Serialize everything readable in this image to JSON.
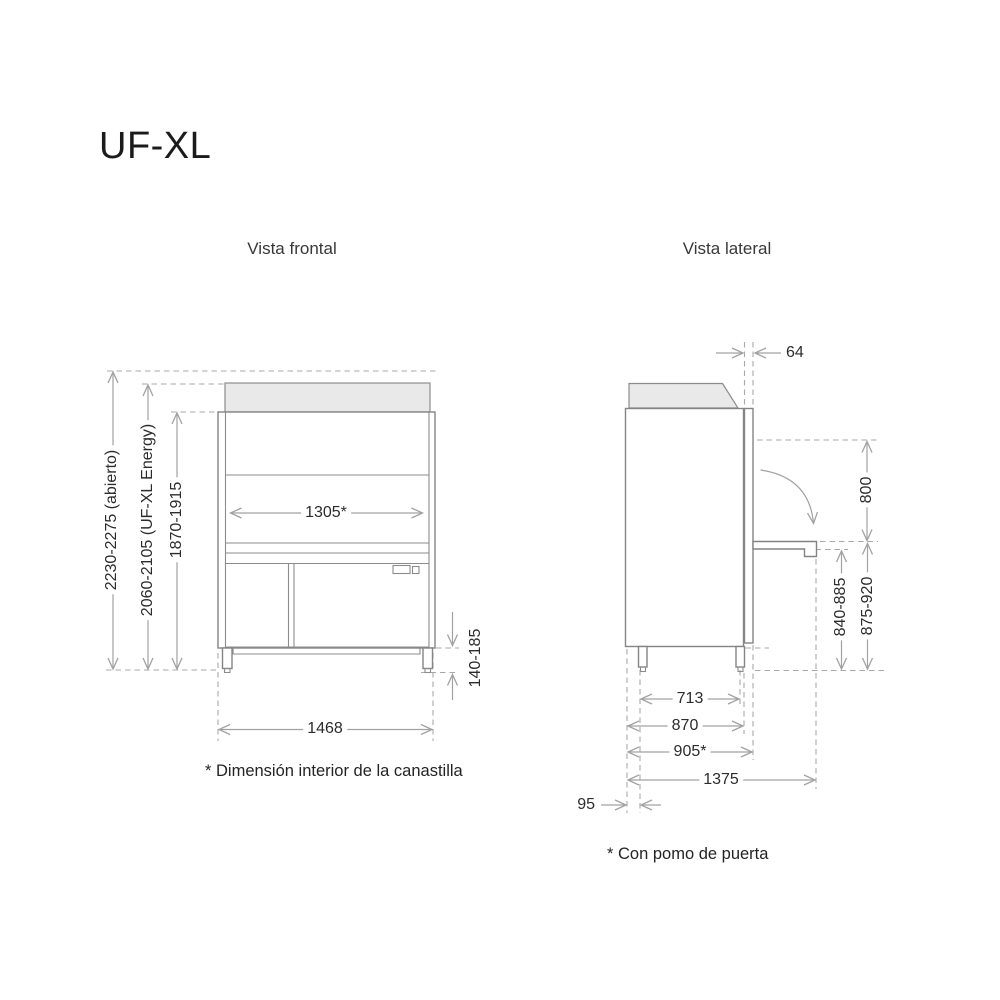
{
  "title": "UF-XL",
  "views": {
    "front": {
      "label": "Vista frontal",
      "note": "* Dimensión interior de la canastilla",
      "dimensions": {
        "overall_height_open": "2230-2275 (abierto)",
        "overall_height_energy": "2060-2105 (UF-XL Energy)",
        "overall_height": "1870-1915",
        "basket_interior_width": "1305*",
        "leg_height": "140-185",
        "overall_width": "1468"
      }
    },
    "side": {
      "label": "Vista lateral",
      "note": "* Con pomo de puerta",
      "dimensions": {
        "door_thickness": "64",
        "door_clearance_height": "800",
        "handle_height_low": "840-885",
        "handle_height_high": "875-920",
        "leg_spacing_depth": "713",
        "body_depth": "870",
        "depth_with_knob": "905*",
        "depth_door_open": "1375",
        "rear_offset": "95"
      }
    }
  },
  "colors": {
    "background": "#ffffff",
    "outline_gray": "#848484",
    "dimension_gray": "#a2a2a2",
    "hood_fill": "#e9e9e9",
    "text": "#2c2c2c"
  }
}
